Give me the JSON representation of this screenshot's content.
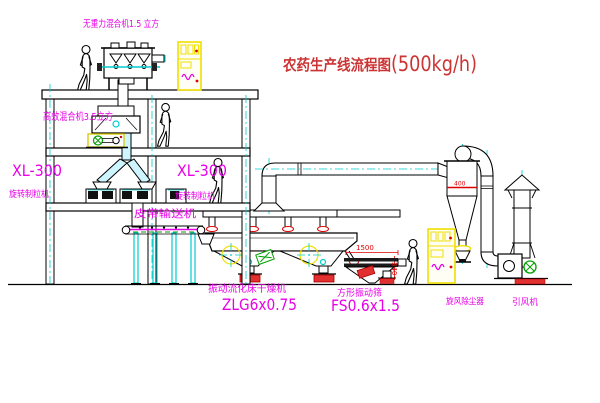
{
  "title": {
    "main": "农药生产线流程图",
    "capacity": "(500kg/h)"
  },
  "labels": {
    "gravity_mixer": "无重力混合机1.5 立方",
    "high_eff_mixer": "高效混合机3.5立方",
    "granulator_left_model": "XL-300",
    "granulator_left_name": "旋转制粒机",
    "granulator_mid_model": "XL-300",
    "granulator_mid_name": "旋转制粒机",
    "belt_conveyor": "皮带输送机",
    "dryer_name": "振动流化床干燥机",
    "dryer_model": "ZLG6x0.75",
    "screen_name": "方形振动筛",
    "screen_model": "FS0.6x1.5",
    "cyclone_name": "旋风除尘器",
    "fan_name": "引风机"
  },
  "dimensions": {
    "screen_length": "1500",
    "screen_height": "340",
    "cyclone_band": "400"
  },
  "colors": {
    "line": "#000000",
    "centerline": "#00cccc",
    "label": "#e800e8",
    "title": "#cc3333",
    "dimension": "#dd0000",
    "cabinet": "#f0e000",
    "motor": "#00a000",
    "base": "#e03030"
  }
}
